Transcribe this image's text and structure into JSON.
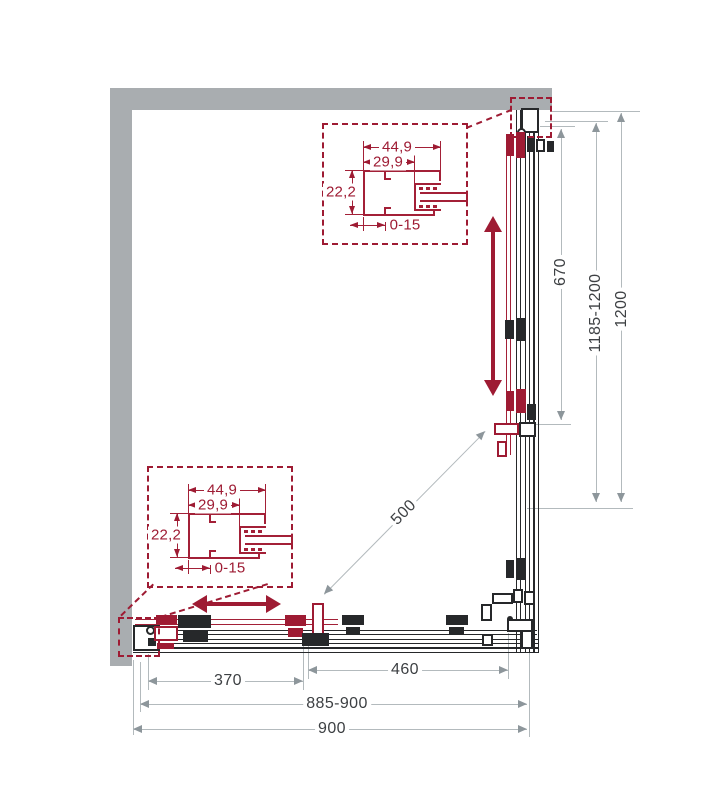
{
  "drawing": {
    "type": "shower-enclosure-corner-plan",
    "colors": {
      "accent_red": "#9e1b33",
      "wall_gray": "#a9adb0",
      "line_black": "#26282a",
      "dim_gray": "#b3babd",
      "text": "#3d4043"
    },
    "dims": {
      "side": {
        "fixed": "670",
        "adjust": "1185-1200",
        "total": "1200"
      },
      "front": {
        "door": "370",
        "fixed": "460",
        "adjust": "885-900",
        "total": "900"
      },
      "diagonal": "500",
      "profile": {
        "outer_width": "44,9",
        "inner_width": "29,9",
        "depth": "22,2",
        "adjust_range": "0-15"
      }
    }
  }
}
